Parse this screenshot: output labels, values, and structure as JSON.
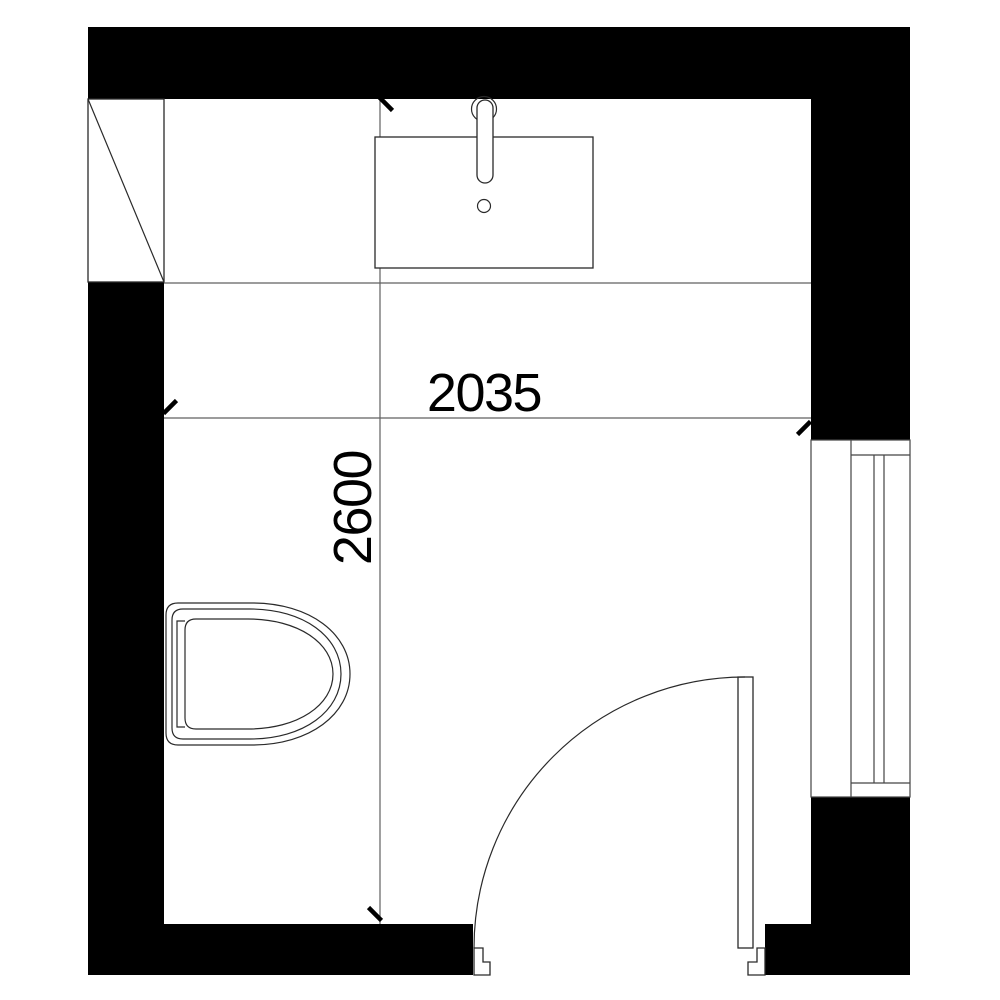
{
  "title": "Bathroom floor plan",
  "dimensions": {
    "width_label": "2035",
    "height_label": "2600"
  },
  "fixtures": {
    "toilet": "toilet",
    "sink": "washbasin-with-faucet",
    "door": "hinged-door-with-swing-arc",
    "window": "window-with-sill",
    "shaft": "diagonal-marked-duct"
  },
  "colors": {
    "background": "#ffffff",
    "wall_fill": "#000000",
    "fixture_outline": "#2a2a2a",
    "guide_line": "#606060",
    "dimension_text": "#000000"
  }
}
